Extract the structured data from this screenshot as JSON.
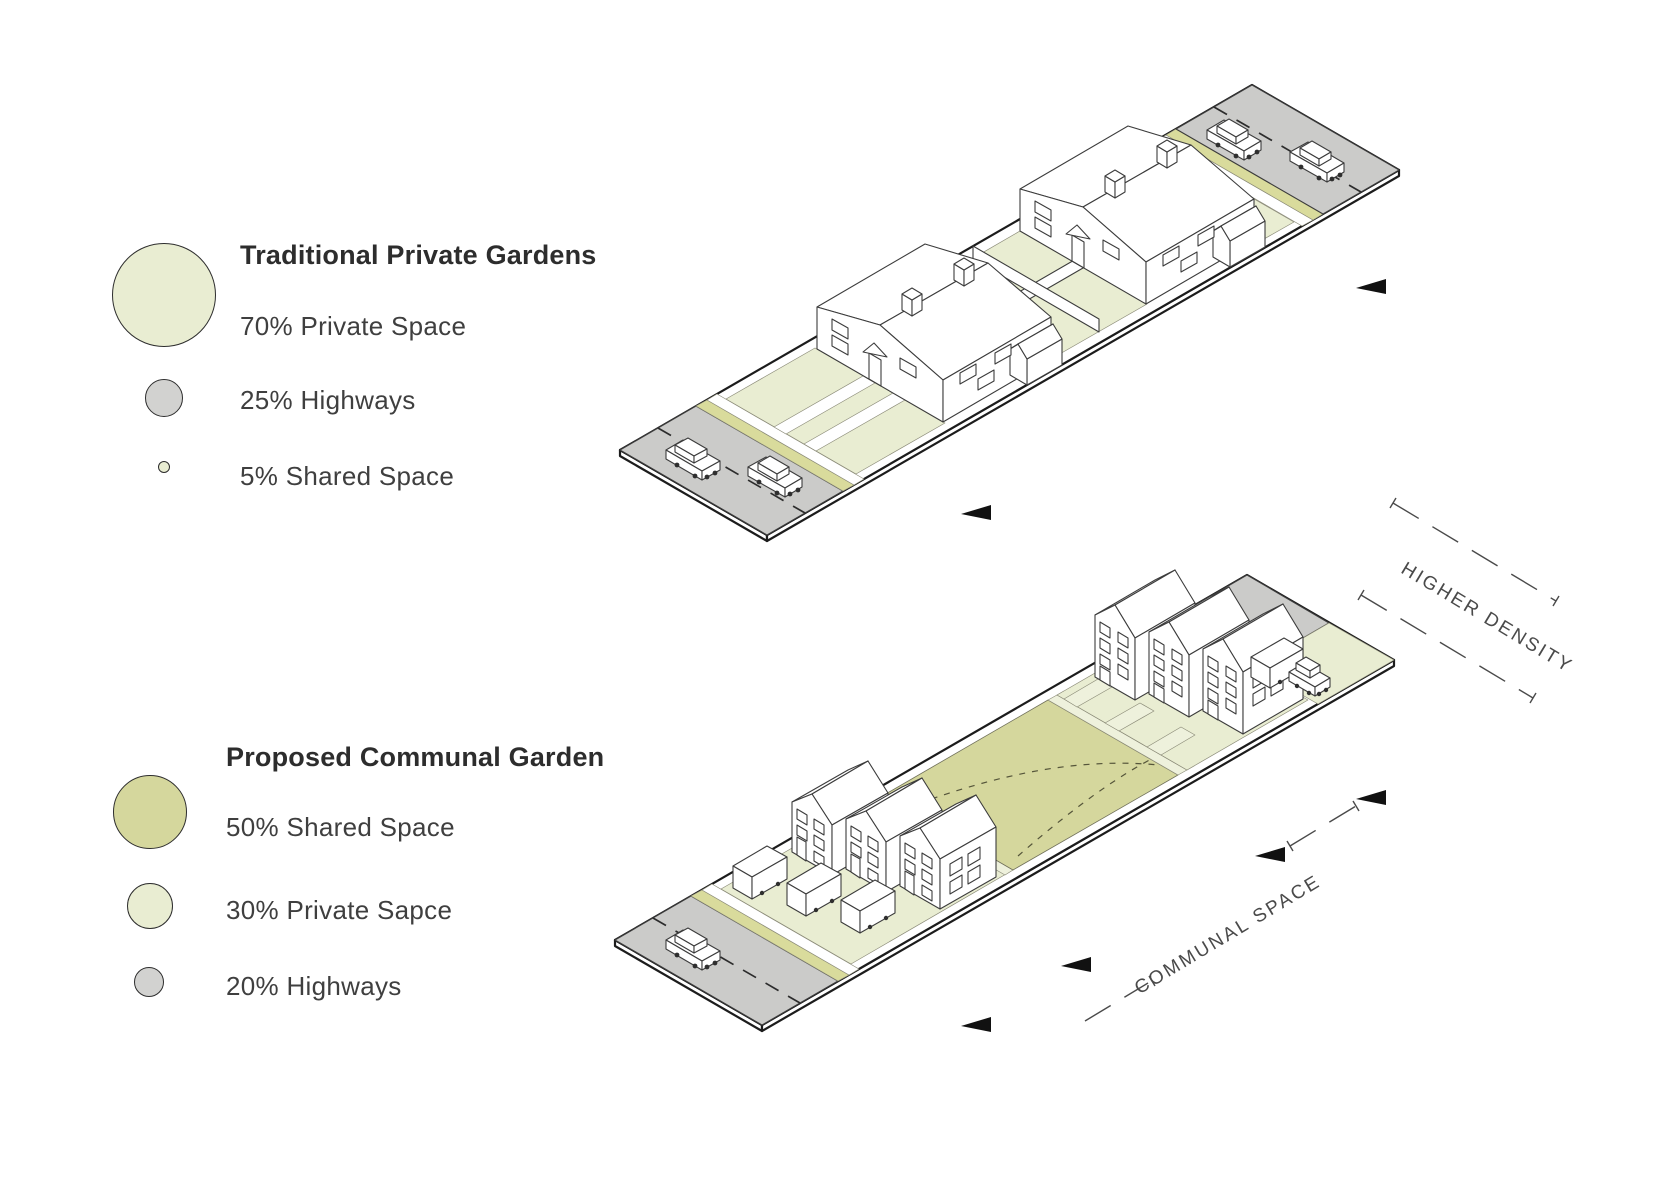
{
  "legend_traditional": {
    "title": "Traditional Private Gardens",
    "items": [
      {
        "label": "70% Private Space",
        "color_key": "private_space"
      },
      {
        "label": "25% Highways",
        "color_key": "highway"
      },
      {
        "label": "5% Shared Space",
        "color_key": "private_space"
      }
    ]
  },
  "legend_proposed": {
    "title": "Proposed Communal Garden",
    "items": [
      {
        "label": "50% Shared Space",
        "color_key": "shared_space"
      },
      {
        "label": "30% Private Sapce",
        "color_key": "private_space"
      },
      {
        "label": "20% Highways",
        "color_key": "highway"
      }
    ]
  },
  "annotations": {
    "higher_density": "HIGHER DENSITY",
    "communal_space": "COMMUNAL SPACE"
  },
  "colors": {
    "private_space": "#e9edd2",
    "shared_space": "#d5d79d",
    "verge": "#d9db9c",
    "highway": "#cbcbc9",
    "legend_gray": "#d2d2d0",
    "outline": "#1c1c1c",
    "line": "#3c3c3c",
    "annotation": "#4a4a4a",
    "text": "#3a3a3a",
    "arrow": "#111111"
  }
}
